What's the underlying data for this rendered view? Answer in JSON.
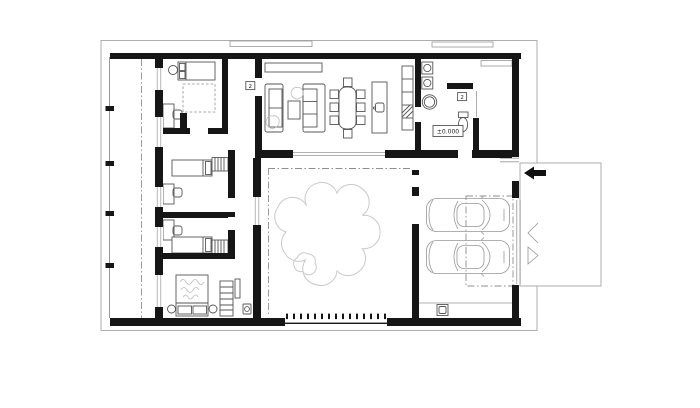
{
  "labels": {
    "floor_level": "±0.000",
    "door_tag_living": "2",
    "door_tag_entry": "2"
  },
  "colors": {
    "background": "#ffffff",
    "wall": "#161616",
    "furniture": "#565656",
    "light": "#979797",
    "frame": "#adadad",
    "tree": "#c9c9c9",
    "dashdot": "#8f8f8f",
    "arrow": "#111111"
  },
  "decor": {
    "fence_slat_count": 15,
    "terrace_column_count": 4,
    "car_count": 2,
    "dining_chair_count": 8,
    "entry_arrow_direction": "left"
  }
}
